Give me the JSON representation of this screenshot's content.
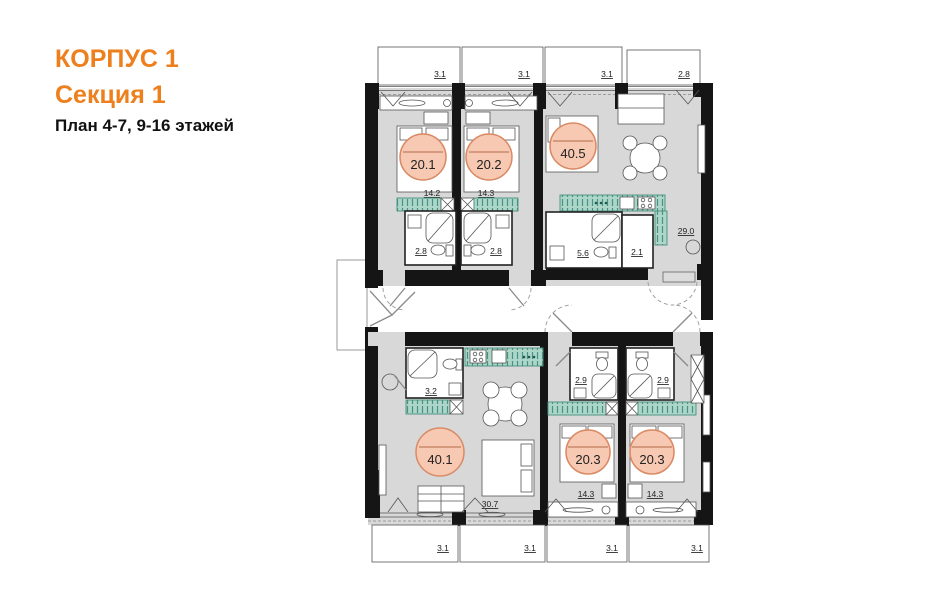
{
  "header": {
    "building": "КОРПУС 1",
    "section": "Секция 1",
    "plan": "План 4-7, 9-16 этажей"
  },
  "upper_section": {
    "balconies": [
      "3.1",
      "3.1",
      "3.1",
      "2.8"
    ],
    "apartments": [
      {
        "total": "20.1",
        "room": "14.2",
        "bathroom": "2.8"
      },
      {
        "total": "20.2",
        "room": "14.3",
        "bathroom": "2.8"
      },
      {
        "total": "40.5",
        "bathroom": "5.6",
        "wc": "2.1",
        "living": "29.0"
      }
    ]
  },
  "lower_section": {
    "balconies": [
      "3.1",
      "3.1",
      "3.1",
      "3.1"
    ],
    "apartments": [
      {
        "total": "40.1",
        "bathroom": "3.2",
        "living": "30.7"
      },
      {
        "total": "20.3",
        "bathroom": "2.9",
        "room": "14.3"
      },
      {
        "total": "20.3",
        "bathroom": "2.9",
        "room": "14.3"
      }
    ]
  },
  "colors": {
    "accent_orange": "#ee7f1d",
    "wall": "#151515",
    "floor": "#d8d8d8",
    "furniture_teal": "#abd6c8",
    "area_circle_fill": "#f7c8b2",
    "area_circle_stroke": "#d98a64"
  }
}
